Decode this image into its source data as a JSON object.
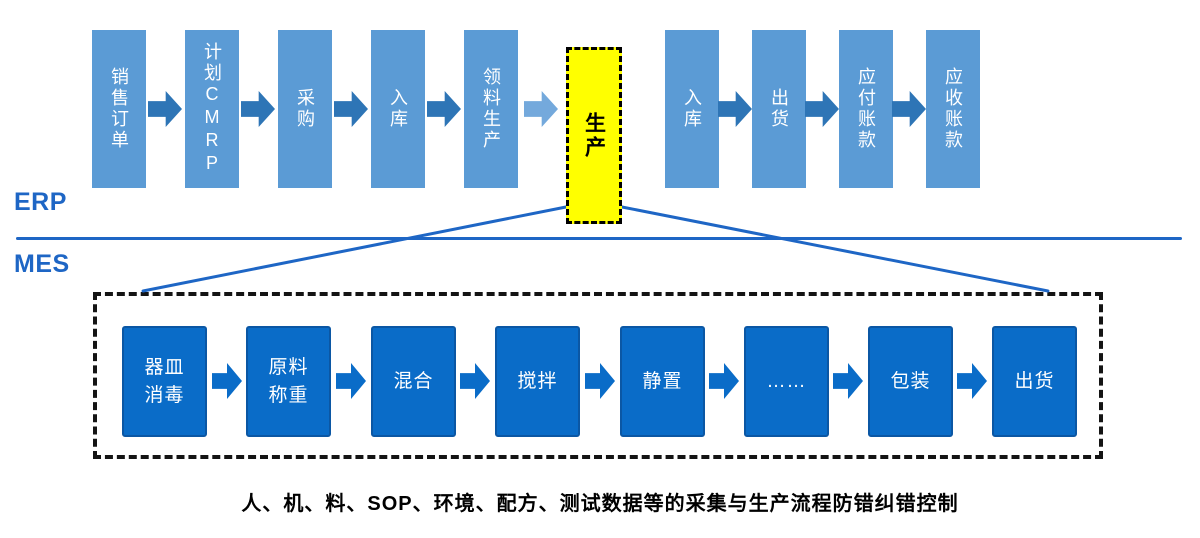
{
  "erp": {
    "label": "ERP",
    "steps": [
      "销售订单",
      "计划CMRP",
      "采购",
      "入库",
      "领料生产"
    ],
    "production": "生产",
    "steps_after": [
      "入库",
      "出货",
      "应付账款",
      "应收账款"
    ]
  },
  "mes": {
    "label": "MES",
    "steps": [
      "器皿\n消毒",
      "原料\n称重",
      "混合",
      "搅拌",
      "静置",
      "……",
      "包装",
      "出货"
    ]
  },
  "caption": "人、机、料、SOP、环境、配方、测试数据等的采集与生产流程防错纠错控制",
  "colors": {
    "erp_box": "#5B9BD5",
    "erp_arrow": "#2E75B6",
    "erp_arrow_light": "#74A9DC",
    "highlight_box_bg": "#FFFF00",
    "highlight_box_border": "#000000",
    "mes_box": "#0A6CC8",
    "mes_box_border": "#0B57A4",
    "blue_line": "#1E66C5",
    "dashed_frame": "#141414",
    "caption_text": "#000000"
  }
}
